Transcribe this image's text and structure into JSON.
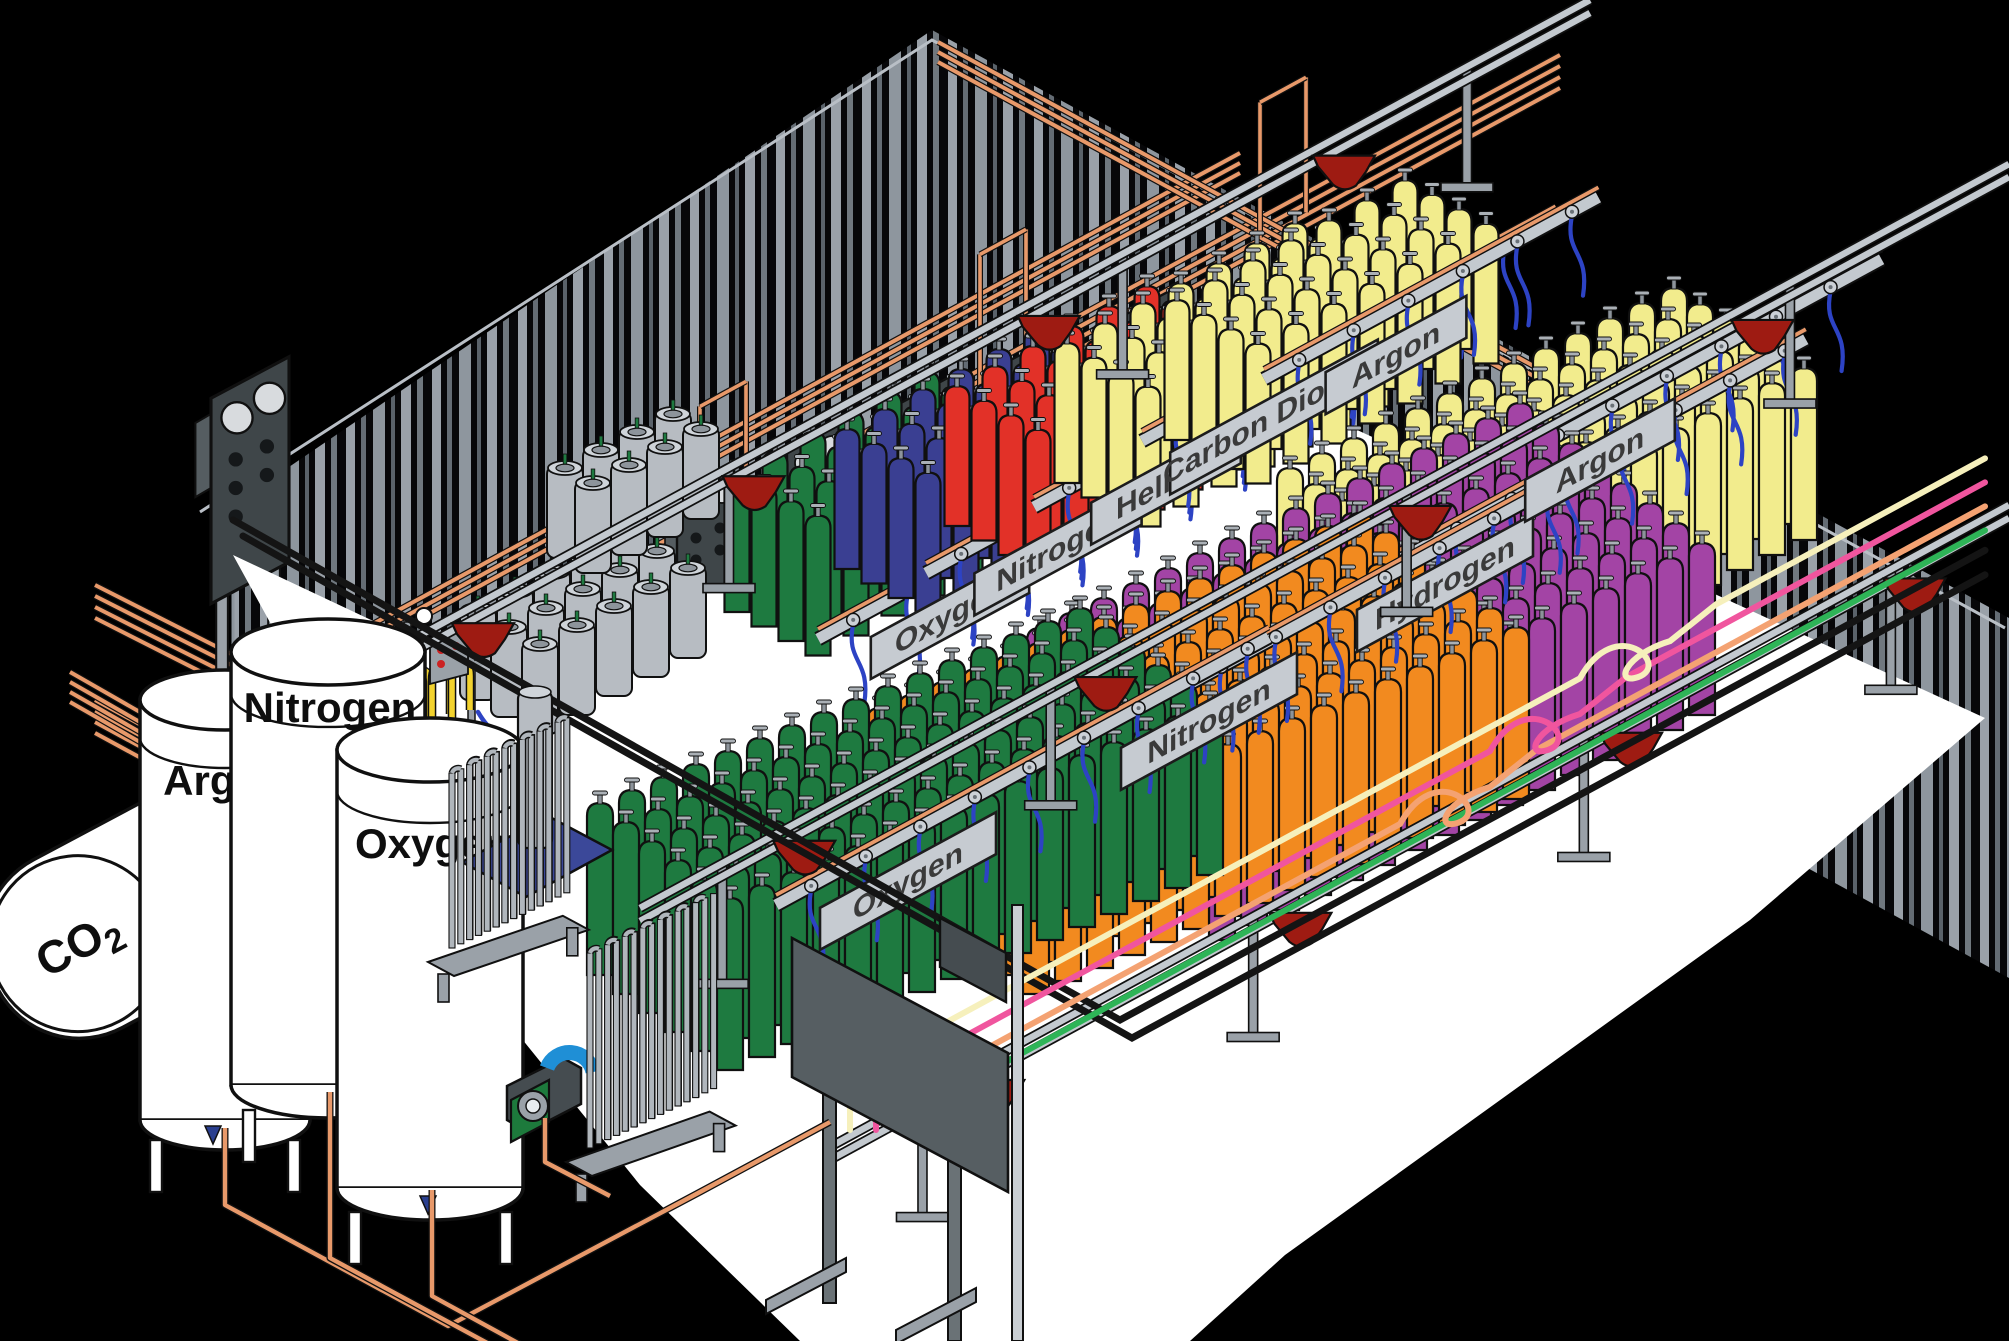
{
  "diagram": {
    "subject": "isometric gas cylinder filling plant cutaway"
  },
  "signs_back": [
    {
      "label": "Oxygen"
    },
    {
      "label": "Nitrogen"
    },
    {
      "label": "Helium"
    },
    {
      "label": "Carbon Dioxide"
    },
    {
      "label": "Argon"
    }
  ],
  "signs_front": [
    {
      "label": "Oxygen"
    },
    {
      "label": "Nitrogen"
    },
    {
      "label": "Hydrogen"
    },
    {
      "label": "Argon"
    }
  ],
  "bulk": {
    "co2_main": "CO",
    "co2_sub": "2",
    "tanks": [
      {
        "label": "Argon"
      },
      {
        "label": "Nitrogen"
      },
      {
        "label": "Oxygen"
      }
    ]
  },
  "colors": {
    "oxygen": "#1e7a40",
    "nitrogen": "#3a3f92",
    "helium": "#e23128",
    "carbon_dioxide": "#f2ec8d",
    "argon": "#f2ec8d",
    "hydrogen": "#a344a5",
    "nitrogen_front": "#f28a1f",
    "cylinder_grey": "#b7bcc2",
    "copper": "#e8996a",
    "hose": "#2d43c4",
    "cart": "#9e1b12",
    "beam": "#c3c9cf",
    "post": "#9aa1a8",
    "sign_face": "#c6cbd1",
    "panel_face": "#3f4649",
    "gauge": "#d8dbde",
    "floor": "#ffffff",
    "wall_stripe_light": "#9aa1a9",
    "wall_stripe_dark": "#646c74",
    "station_yellow": "#f2d22e",
    "skid_blue": "#3b4899",
    "compressor_green": "#1d7a3c",
    "compressor_blue": "#1f8fd6",
    "line_cream": "#f6f0bc",
    "line_pink": "#f0559e",
    "line_salmon": "#f4a272",
    "line_green": "#2eb457",
    "line_black": "#141414"
  },
  "scene": {
    "floor": [
      [
        233,
        555
      ],
      [
        520,
        690
      ],
      [
        760,
        565
      ],
      [
        950,
        455
      ],
      [
        1150,
        335
      ],
      [
        1985,
        718
      ],
      [
        1750,
        920
      ],
      [
        1285,
        1255
      ],
      [
        1190,
        1341
      ],
      [
        800,
        1341
      ],
      [
        640,
        1185
      ],
      [
        450,
        950
      ]
    ],
    "bundles": [
      {
        "pts": [
          [
            95,
            700
          ],
          [
            233,
            775
          ],
          [
            1560,
            55
          ]
        ],
        "n": 4,
        "gap": 11
      },
      {
        "pts": [
          [
            95,
            585
          ],
          [
            233,
            655
          ],
          [
            560,
            833
          ]
        ],
        "n": 4,
        "gap": 11
      },
      {
        "pts": [
          [
            233,
            700
          ],
          [
            1240,
            153
          ]
        ],
        "n": 3,
        "gap": 10
      },
      {
        "pts": [
          [
            938,
            42
          ],
          [
            1620,
            413
          ]
        ],
        "n": 3,
        "gap": 10
      },
      {
        "pts": [
          [
            70,
            672
          ],
          [
            402,
            862
          ],
          [
            836,
            1004
          ]
        ],
        "n": 4,
        "gap": 10
      }
    ],
    "goalposts": [
      {
        "x": 700
      },
      {
        "x": 980
      },
      {
        "x": 1260
      }
    ],
    "groundPipes": [
      [
        [
          225,
          1128
        ],
        [
          225,
          1205
        ],
        [
          448,
          1326
        ],
        [
          700,
          1192
        ],
        [
          830,
          1122
        ]
      ],
      [
        [
          330,
          1092
        ],
        [
          330,
          1258
        ],
        [
          515,
          1358
        ]
      ],
      [
        [
          432,
          1190
        ],
        [
          432,
          1296
        ],
        [
          600,
          1388
        ]
      ],
      [
        [
          545,
          1118
        ],
        [
          545,
          1162
        ],
        [
          610,
          1196
        ]
      ]
    ],
    "panels": [
      {
        "x": 250,
        "y": 462,
        "s": 1.3
      },
      {
        "x": 707,
        "y": 540,
        "s": 1
      },
      {
        "x": 817,
        "y": 497,
        "s": 1
      },
      {
        "x": 927,
        "y": 454,
        "s": 1
      },
      {
        "x": 1037,
        "y": 411,
        "s": 1
      },
      {
        "x": 1147,
        "y": 368,
        "s": 1
      }
    ],
    "dewarClusters": [
      {
        "x": 478,
        "y": 700,
        "cols": 5,
        "rows": 3,
        "ax": 37,
        "ay": -19,
        "dx": 31,
        "dy": 17
      },
      {
        "x": 565,
        "y": 558,
        "cols": 4,
        "rows": 2,
        "ax": 36,
        "ay": -18,
        "dx": 28,
        "dy": 15
      }
    ],
    "stations": [
      {
        "x": 352,
        "y": 762
      },
      {
        "x": 438,
        "y": 742
      }
    ],
    "banksBack": [
      {
        "color": "oxygen",
        "x": 737,
        "y": 612,
        "cols": 6,
        "rows": 4,
        "ax": 38,
        "ay": -20,
        "dx": 27,
        "dy": 14.5,
        "w": 25,
        "h": 140,
        "rail": {
          "x": 818,
          "y": 639,
          "len": 430
        }
      },
      {
        "color": "nitrogen",
        "x": 847,
        "y": 569,
        "cols": 6,
        "rows": 4,
        "ax": 38,
        "ay": -20,
        "dx": 27,
        "dy": 14.5,
        "w": 25,
        "h": 140,
        "rail": {
          "x": 926,
          "y": 573,
          "len": 430
        }
      },
      {
        "color": "helium",
        "x": 957,
        "y": 526,
        "cols": 6,
        "rows": 4,
        "ax": 38,
        "ay": -20,
        "dx": 27,
        "dy": 14.5,
        "w": 25,
        "h": 140,
        "rail": {
          "x": 1034,
          "y": 507,
          "len": 430
        }
      },
      {
        "color": "carbon_dioxide",
        "x": 1067,
        "y": 483,
        "cols": 7,
        "rows": 4,
        "ax": 38,
        "ay": -20,
        "dx": 27,
        "dy": 14.5,
        "w": 25,
        "h": 140,
        "rail": {
          "x": 1142,
          "y": 441,
          "len": 470
        }
      },
      {
        "color": "argon",
        "x": 1177,
        "y": 440,
        "cols": 7,
        "rows": 4,
        "ax": 38,
        "ay": -20,
        "dx": 27,
        "dy": 14.5,
        "w": 25,
        "h": 140,
        "rail": {
          "x": 1264,
          "y": 379,
          "len": 380
        }
      }
    ],
    "banksFront": [
      {
        "color": "argon",
        "x": 1290,
        "y": 640,
        "cols": 13,
        "rows": 6,
        "ax": 32,
        "ay": -15,
        "dx": 26,
        "dy": 16,
        "w": 26,
        "h": 172,
        "rail": {
          "x": 1468,
          "y": 484,
          "len": 470
        }
      },
      {
        "color": "hydrogen",
        "x": 1040,
        "y": 800,
        "cols": 16,
        "rows": 8,
        "ax": 32,
        "ay": -15,
        "dx": 26,
        "dy": 20,
        "w": 26,
        "h": 172,
        "rail": {
          "x": 1313,
          "y": 607,
          "len": 560
        }
      },
      {
        "color": "nitrogen_front",
        "x": 880,
        "y": 880,
        "cols": 16,
        "rows": 7,
        "ax": 32,
        "ay": -13,
        "dx": 26,
        "dy": 19,
        "w": 26,
        "h": 172,
        "rail": {
          "x": 1077,
          "y": 745,
          "len": 560
        }
      },
      {
        "color": "oxygen",
        "x": 600,
        "y": 975,
        "cols": 16,
        "rows": 6,
        "ax": 32,
        "ay": -13,
        "dx": 26,
        "dy": 19,
        "w": 26,
        "h": 172,
        "rail": {
          "x": 776,
          "y": 905,
          "len": 560
        }
      }
    ],
    "convRails": [
      {
        "x1": 360,
        "y1": 668,
        "x2": 1590,
        "y2": 0,
        "carts": [
          0.1,
          0.32,
          0.56,
          0.8
        ],
        "posts": [
          0.04,
          0.3,
          0.62,
          0.9
        ]
      },
      {
        "x1": 640,
        "y1": 908,
        "x2": 2009,
        "y2": 164,
        "carts": [
          0.12,
          0.34,
          0.57,
          0.82
        ],
        "posts": [
          0.06,
          0.3,
          0.56,
          0.84
        ]
      },
      {
        "x1": 828,
        "y1": 1148,
        "x2": 2009,
        "y2": 505,
        "carts": [
          0.14,
          0.4,
          0.68,
          0.92
        ],
        "posts": [
          0.08,
          0.36,
          0.64,
          0.9
        ]
      }
    ],
    "gasLines": [
      {
        "colorKey": "line_black",
        "w": 7,
        "seg": [
          [
            233,
            520
          ],
          [
            1120,
            1020
          ]
        ],
        "refX": 1120,
        "refY": 1020
      },
      {
        "colorKey": "line_black",
        "w": 7,
        "seg": [
          [
            243,
            536
          ],
          [
            1132,
            1038
          ]
        ],
        "refX": 1132,
        "refY": 1038
      },
      {
        "colorKey": "line_green",
        "w": 6,
        "vx": 928,
        "refX": 1400,
        "refY": 848
      },
      {
        "colorKey": "line_salmon",
        "w": 6,
        "vx": 902,
        "refX": 1400,
        "refY": 824,
        "wx": 1450
      },
      {
        "colorKey": "line_pink",
        "w": 6,
        "vx": 876,
        "refX": 1400,
        "refY": 800,
        "wx": 1540
      },
      {
        "colorKey": "line_cream",
        "w": 6,
        "vx": 850,
        "refX": 1400,
        "refY": 776,
        "wx": 1630
      }
    ],
    "vaporizers": [
      {
        "x": 452,
        "y": 948,
        "n": 12,
        "h": 175,
        "rows": 2
      },
      {
        "x": 590,
        "y": 1148,
        "n": 13,
        "h": 195,
        "rows": 2
      }
    ]
  }
}
